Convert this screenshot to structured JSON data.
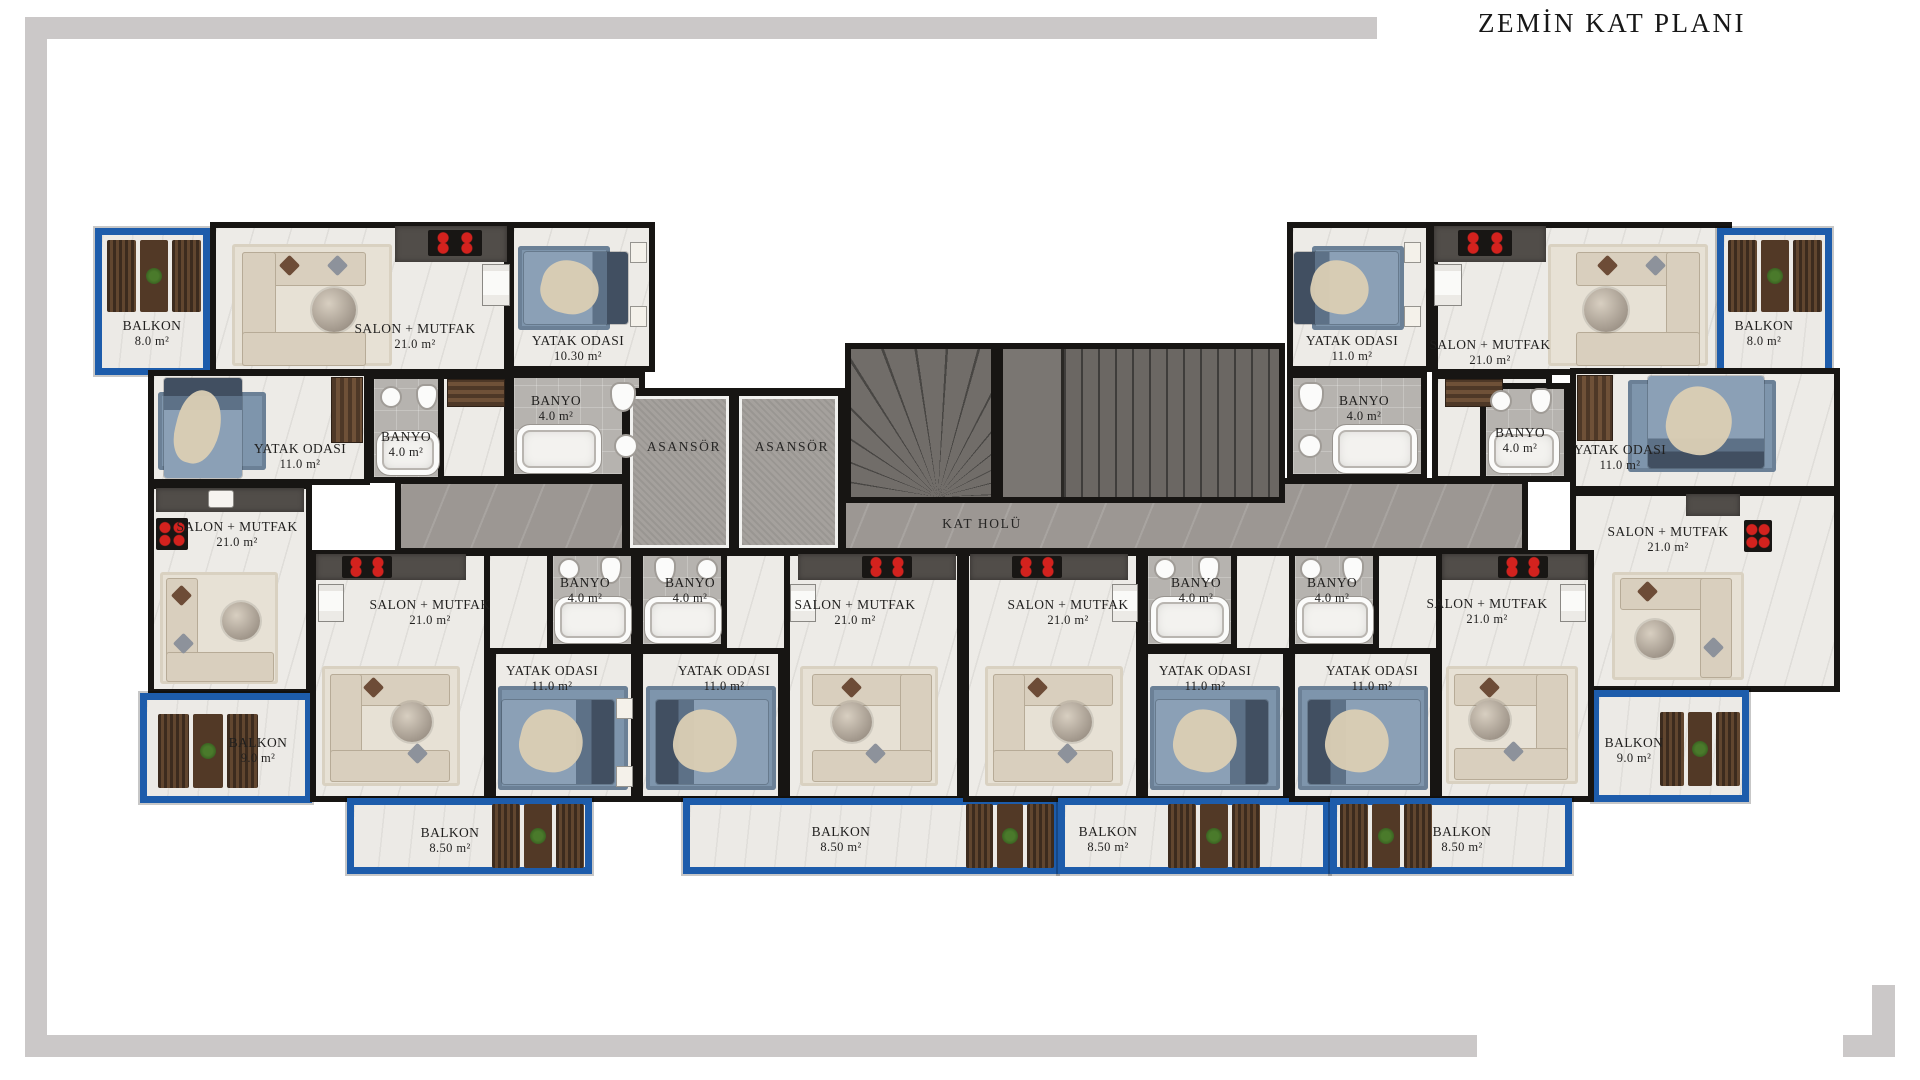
{
  "page": {
    "title": "ZEMİN KAT PLANI"
  },
  "core": {
    "elevators": [
      "ASANSÖR",
      "ASANSÖR"
    ],
    "hall": "KAT HOLÜ"
  },
  "rooms": [
    {
      "id": "balkon-tl",
      "name": "BALKON",
      "area": "8.0 m²"
    },
    {
      "id": "salon-tl",
      "name": "SALON + MUTFAK",
      "area": "21.0 m²"
    },
    {
      "id": "yatak-tl",
      "name": "YATAK ODASI",
      "area": "10.30 m²"
    },
    {
      "id": "banyo-tl",
      "name": "BANYO",
      "area": "4.0 m²"
    },
    {
      "id": "yatak-l",
      "name": "YATAK ODASI",
      "area": "11.0 m²"
    },
    {
      "id": "banyo-l",
      "name": "BANYO",
      "area": "4.0 m²"
    },
    {
      "id": "salon-l",
      "name": "SALON + MUTFAK",
      "area": "21.0 m²"
    },
    {
      "id": "balkon-l",
      "name": "BALKON",
      "area": "9.0 m²"
    },
    {
      "id": "salon-b1",
      "name": "SALON + MUTFAK",
      "area": "21.0 m²"
    },
    {
      "id": "banyo-b1",
      "name": "BANYO",
      "area": "4.0 m²"
    },
    {
      "id": "yatak-b1",
      "name": "YATAK ODASI",
      "area": "11.0 m²"
    },
    {
      "id": "balkon-b1",
      "name": "BALKON",
      "area": "8.50 m²"
    },
    {
      "id": "banyo-b2",
      "name": "BANYO",
      "area": "4.0 m²"
    },
    {
      "id": "yatak-b2",
      "name": "YATAK ODASI",
      "area": "11.0 m²"
    },
    {
      "id": "salon-b2",
      "name": "SALON + MUTFAK",
      "area": "21.0 m²"
    },
    {
      "id": "balkon-b2",
      "name": "BALKON",
      "area": "8.50 m²"
    },
    {
      "id": "salon-b3",
      "name": "SALON + MUTFAK",
      "area": "21.0 m²"
    },
    {
      "id": "banyo-b3",
      "name": "BANYO",
      "area": "4.0 m²"
    },
    {
      "id": "yatak-b3",
      "name": "YATAK ODASI",
      "area": "11.0 m²"
    },
    {
      "id": "balkon-b3",
      "name": "BALKON",
      "area": "8.50 m²"
    },
    {
      "id": "banyo-b4",
      "name": "BANYO",
      "area": "4.0 m²"
    },
    {
      "id": "yatak-b4",
      "name": "YATAK ODASI",
      "area": "11.0 m²"
    },
    {
      "id": "salon-b4",
      "name": "SALON + MUTFAK",
      "area": "21.0 m²"
    },
    {
      "id": "balkon-b4",
      "name": "BALKON",
      "area": "8.50 m²"
    },
    {
      "id": "yatak-tr",
      "name": "YATAK ODASI",
      "area": "11.0 m²"
    },
    {
      "id": "banyo-tr",
      "name": "BANYO",
      "area": "4.0 m²"
    },
    {
      "id": "salon-tr",
      "name": "SALON + MUTFAK",
      "area": "21.0 m²"
    },
    {
      "id": "balkon-tr",
      "name": "BALKON",
      "area": "8.0 m²"
    },
    {
      "id": "banyo-r",
      "name": "BANYO",
      "area": "4.0 m²"
    },
    {
      "id": "yatak-r",
      "name": "YATAK ODASI",
      "area": "11.0 m²"
    },
    {
      "id": "salon-r",
      "name": "SALON + MUTFAK",
      "area": "21.0 m²"
    },
    {
      "id": "balkon-r",
      "name": "BALKON",
      "area": "9.0 m²"
    }
  ]
}
